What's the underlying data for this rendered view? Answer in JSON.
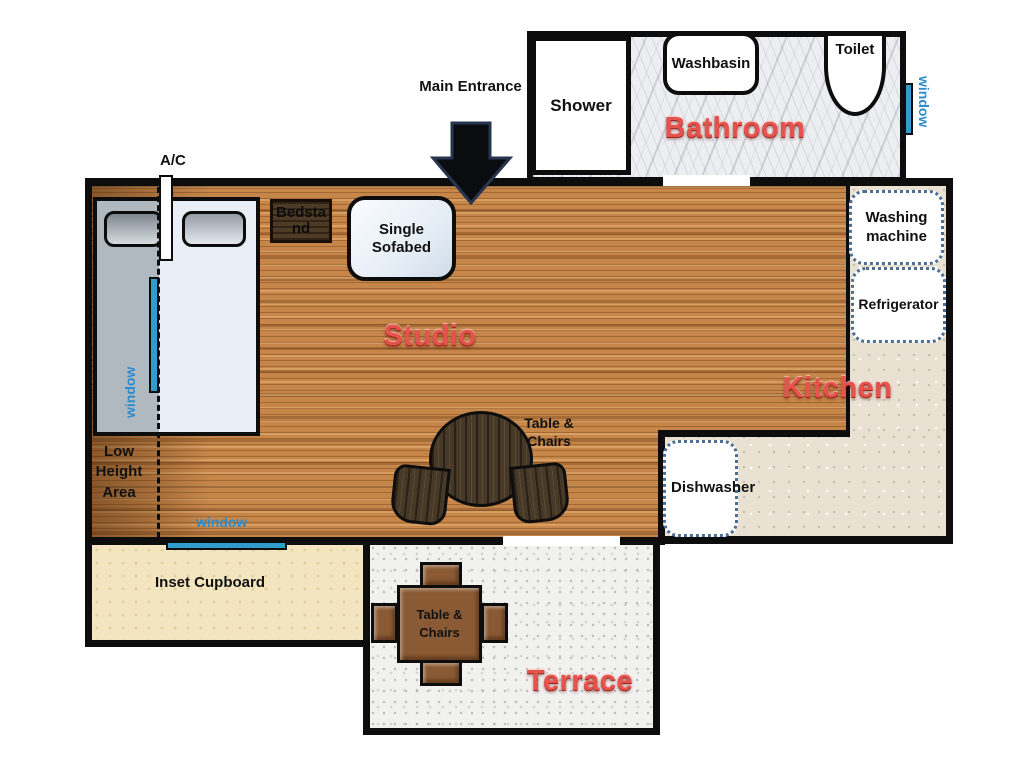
{
  "rooms": {
    "studio": "Studio",
    "bathroom": "Bathroom",
    "kitchen": "Kitchen",
    "terrace": "Terrace"
  },
  "labels": {
    "main_entrance": "Main Entrance",
    "ac_unit": "A/C",
    "low_height_area": "Low Height Area",
    "inset_cupboard": "Inset Cupboard",
    "window_roof": "window",
    "window_bottom": "window",
    "window_bathroom": "window"
  },
  "furniture": {
    "shower": "Shower",
    "washbasin": "Washbasin",
    "toilet": "Toilet",
    "bedstand": "Bedstand",
    "single_sofabed": "Single Sofabed",
    "studio_table": "Table & Chairs",
    "terrace_table": "Table & Chairs",
    "washing_machine": "Washing machine",
    "refrigerator": "Refrigerator",
    "dishwasher": "Dishwasher"
  },
  "colors": {
    "room_label_red": "#e4534c",
    "window_blue": "#2d8ccb",
    "wood_base": "#c6864a",
    "kitchen_floor": "#e9e2d3",
    "cupboard_floor": "#f2e5bf",
    "terrace_floor": "#f1f1ef",
    "bathroom_floor": "#edeef1",
    "wall": "#0d0d0d"
  }
}
